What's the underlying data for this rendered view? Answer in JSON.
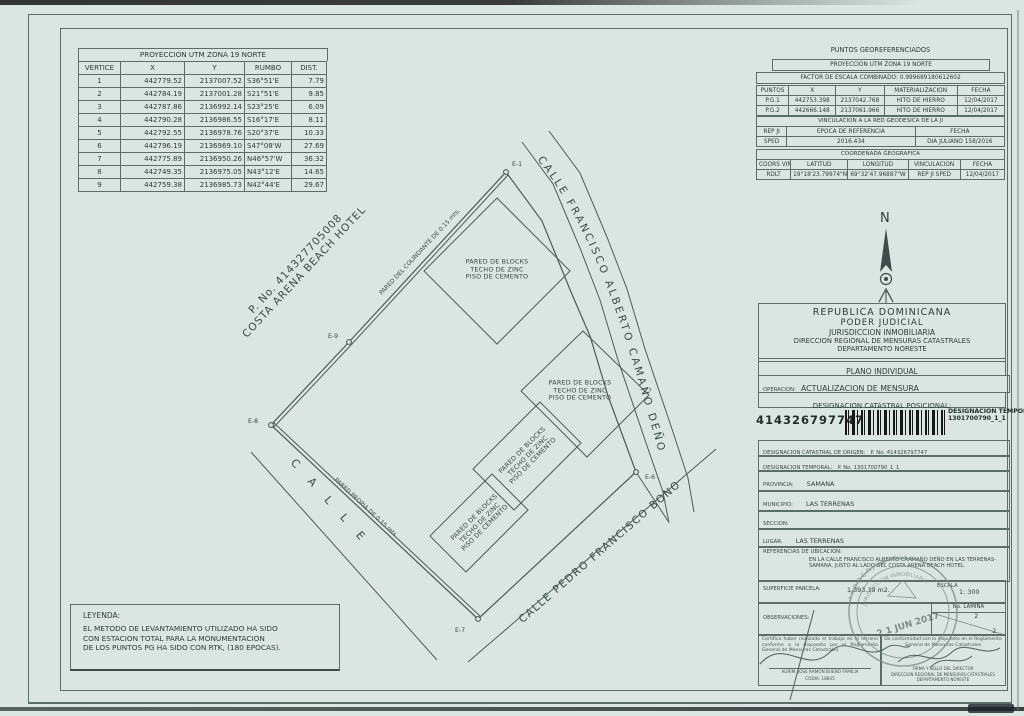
{
  "utm_table": {
    "title": "PROYECCION UTM ZONA 19 NORTE",
    "headers": [
      "VERTICE",
      "X",
      "Y",
      "RUMBO",
      "DIST."
    ],
    "rows": [
      [
        "1",
        "442779.52",
        "2137007.52",
        "S36°51'E",
        "7.79"
      ],
      [
        "2",
        "442784.19",
        "2137001.28",
        "S21°51'E",
        "9.85"
      ],
      [
        "3",
        "442787.86",
        "2136992.14",
        "S23°25'E",
        "6.09"
      ],
      [
        "4",
        "442790.28",
        "2136986.55",
        "S16°17'E",
        "8.11"
      ],
      [
        "5",
        "442792.55",
        "2136978.76",
        "S20°37'E",
        "10.33"
      ],
      [
        "6",
        "442796.19",
        "2136969.10",
        "S47°08'W",
        "27.69"
      ],
      [
        "7",
        "442775.89",
        "2136950.26",
        "N46°57'W",
        "36.32"
      ],
      [
        "8",
        "442749.35",
        "2136975.05",
        "N43°12'E",
        "14.65"
      ],
      [
        "9",
        "442759.38",
        "2136985.73",
        "N42°44'E",
        "29.67"
      ]
    ]
  },
  "geo": {
    "title": "PUNTOS GEOREFERENCIADOS",
    "subtitle": "PROYECCION UTM ZONA 19 NORTE",
    "factor": "FACTOR DE ESCALA COMBINADO:   0.999689180612602",
    "points_headers": [
      "PUNTOS",
      "X",
      "Y",
      "MATERIALIZACION",
      "FECHA"
    ],
    "points_rows": [
      [
        "P.G.1",
        "442753.398",
        "2137042.768",
        "HITO DE HIERRO",
        "12/04/2017"
      ],
      [
        "P.G.2",
        "442666.148",
        "2137061.966",
        "HITO DE HIERRO",
        "12/04/2017"
      ]
    ],
    "vinc_title": "VINCULACION A LA RED GEODESICA DE LA JI",
    "vinc_headers": [
      "REP JI",
      "EPOCA DE REFERENCIA",
      "FECHA"
    ],
    "vinc_rows": [
      [
        "SPED",
        "2016.434",
        "DIA JULIANO 158/2016"
      ]
    ],
    "coord_title": "COORDENADA GEOGRAFICA",
    "coord_headers": [
      "COORS VINCULADA",
      "LATITUD",
      "LONGITUD",
      "VINCULACION",
      "FECHA"
    ],
    "coord_rows": [
      [
        "RDLT",
        "19°18'23.79974\"N",
        "69°32'47.96887\"W",
        "REP JI SPED",
        "12/04/2017"
      ]
    ]
  },
  "compass": {
    "label": "N"
  },
  "panel": {
    "header_lines": [
      "REPUBLICA  DOMINICANA",
      "PODER  JUDICIAL",
      "JURISDICCION INMOBILIARIA",
      "DIRECCION REGIONAL DE MENSURAS CATASTRALES",
      "DEPARTAMENTO NORESTE"
    ],
    "plano": "PLANO INDIVIDUAL",
    "operacion_label": "OPERACION:",
    "operacion_value": "ACTUALIZACION DE MENSURA",
    "designacion_title": "DESIGNACION CATASTRAL POSICIONAL:",
    "designacion_number": "414326797747",
    "temporal_label": "DESIGNACION TEMPORAL",
    "temporal_value": "1301700790_1_1",
    "origen_label": "DESIGNACION CATASTRAL  DE ORIGEN:",
    "origen_value": "P. No. 414326797747",
    "temporal2_label": "DESIGNACION TEMPORAL:",
    "temporal2_value": "P. No. 1301700790_1_1",
    "provincia_label": "PROVINCIA:",
    "provincia_value": "SAMANA",
    "municipio_label": "MUNICIPIO:",
    "municipio_value": "LAS TERRENAS",
    "seccion_label": "SECCION:",
    "seccion_value": "",
    "lugar_label": "LUGAR:",
    "lugar_value": "LAS TERRENAS",
    "referencias_label": "REFERENCIAS DE UBICACION:",
    "referencias_value": "EN LA CALLE FRANCISCO ALBERTO CAAMAÑO DEÑO EN LAS TERRENAS-SAMANA, JUSTO AL LADO DEL COSTA ARENA BEACH HOTEL.",
    "superficie_label": "SUPERFICIE PARCELA:",
    "superficie_value": "1,393.39 m2.",
    "escala_label": "ESCALA",
    "escala_value": "1: 300",
    "lamina_label": "No. LAMINA",
    "lamina_top": "2",
    "lamina_bottom": "2",
    "observaciones_label": "OBSERVACIONES:",
    "cert_left_text": "Certifica haber realizado el trabajo en el terreno conforme a lo dispuesto por el Reglamento General de Mensuras Catastrales",
    "cert_left_name": "AGRIM. JOSE RAMON BUENO FAMILIA",
    "cert_left_codia": "CODIA:   18845",
    "cert_right_text": "De conformidad con lo dispuesto en el Reglamento General de Mensuras Catastrales",
    "cert_right_line1": "FIRMA Y SELLO DEL DIRECTOR",
    "cert_right_line2": "DIRECCION REGIONAL DE MENSURAS CATASTRALES",
    "cert_right_line3": "DEPARTAMENTO NORESTE"
  },
  "stamp": {
    "ring_text": "*  P O D E R   J U D I C I A L  *",
    "ring_text2": "JURISDICCION  INMOBILIARIA",
    "date": "2 1  JUN 2017"
  },
  "drawing": {
    "hotel_line1": "P. No. 414327705008",
    "hotel_line2": "COSTA ARENA BEACH HOTEL",
    "street_right": "CALLE  FRANCISCO  ALBERTO  CAMAÑO  DEÑO",
    "street_bottom": "CALLE PEDRO FRANCISCO BONO",
    "street_left": "C A L L E",
    "wall_colindante": "PARED DEL COLINDANTE DE 0.15 mts.",
    "wall_propia": "PARED PROPIA DE 0.15 mts.",
    "building_label": [
      "PARED DE BLOCKS",
      "TECHO DE ZINC",
      "PISO DE CEMENTO"
    ],
    "vertices": {
      "e1": "E-1",
      "e6": "E-6",
      "e7": "E-7",
      "e8": "E-8",
      "e9": "E-9"
    }
  },
  "legend": {
    "title": "LEYENDA:",
    "line1": "EL METODO DE LEVANTAMIENTO UTILIZADO HA SIDO",
    "line2": "CON ESTACION TOTAL PARA LA MONUMENTACION",
    "line3": "DE LOS PUNTOS PG HA SIDO CON RTK, (180 EPOCAS)."
  }
}
